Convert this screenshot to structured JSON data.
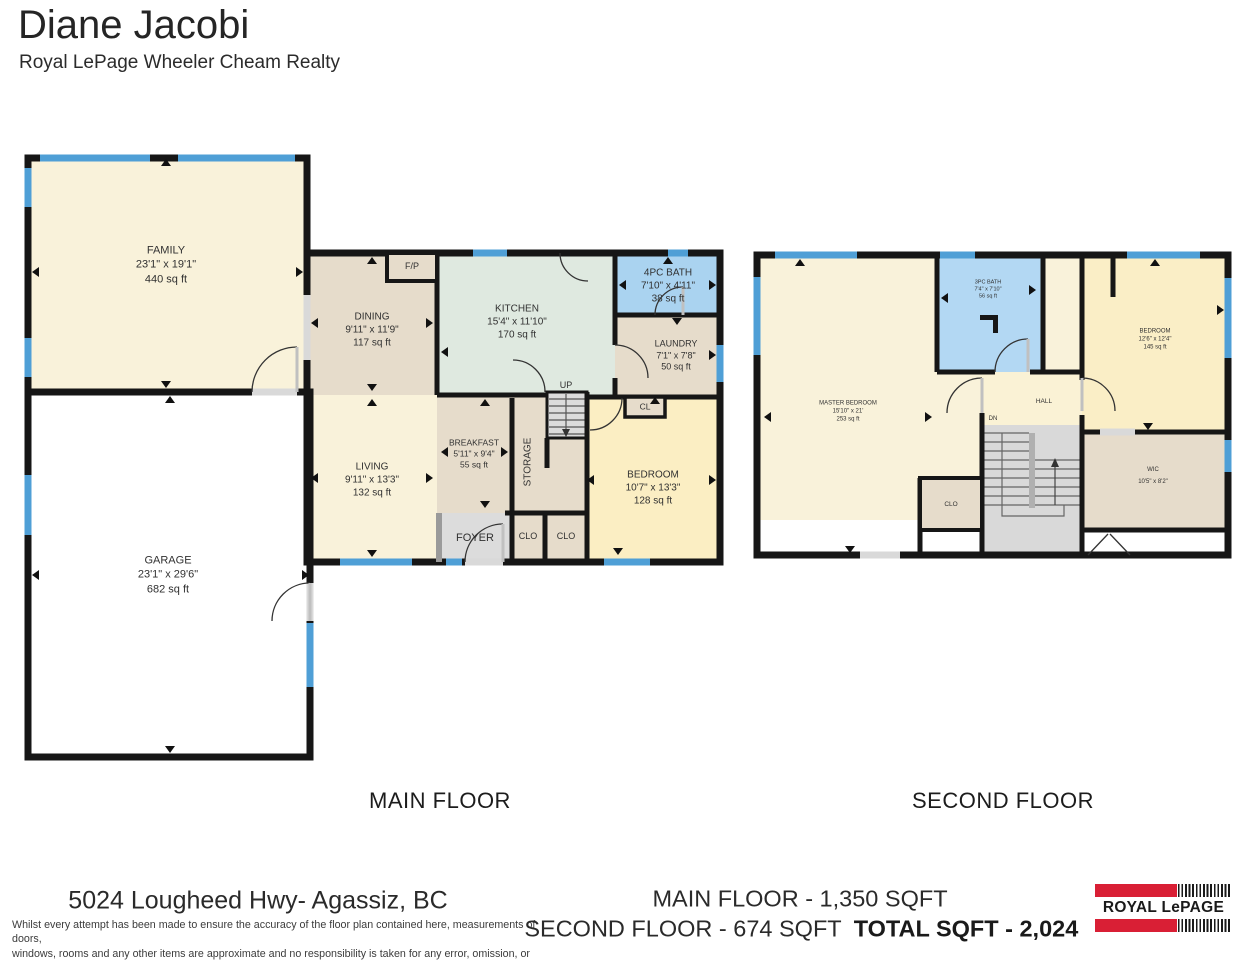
{
  "header": {
    "agent_name": "Diane Jacobi",
    "brokerage": "Royal LePage Wheeler Cheam Realty"
  },
  "main_floor": {
    "title": "MAIN FLOOR",
    "rooms": {
      "family": {
        "name": "FAMILY",
        "dims": "23'1\" x 19'1\"",
        "area": "440 sq ft"
      },
      "garage": {
        "name": "GARAGE",
        "dims": "23'1\" x 29'6\"",
        "area": "682 sq ft"
      },
      "dining": {
        "name": "DINING",
        "dims": "9'11\" x 11'9\"",
        "area": "117 sq ft"
      },
      "kitchen": {
        "name": "KITCHEN",
        "dims": "15'4\" x 11'10\"",
        "area": "170 sq ft"
      },
      "bath": {
        "name": "4PC BATH",
        "dims": "7'10\" x 4'11\"",
        "area": "38 sq ft"
      },
      "laundry": {
        "name": "LAUNDRY",
        "dims": "7'1\" x 7'8\"",
        "area": "50 sq ft"
      },
      "living": {
        "name": "LIVING",
        "dims": "9'11\" x 13'3\"",
        "area": "132 sq ft"
      },
      "breakfast": {
        "name": "BREAKFAST",
        "dims": "5'11\" x 9'4\"",
        "area": "55 sq ft"
      },
      "bedroom": {
        "name": "BEDROOM",
        "dims": "10'7\" x 13'3\"",
        "area": "128 sq ft"
      },
      "storage": {
        "name": "STORAGE"
      },
      "foyer": {
        "name": "FOYER"
      },
      "fireplace": {
        "name": "F/P"
      },
      "stairs_up": {
        "name": "UP"
      },
      "closet_cl": {
        "name": "CL"
      },
      "closet_clo": {
        "name": "CLO"
      }
    }
  },
  "second_floor": {
    "title": "SECOND FLOOR",
    "rooms": {
      "master": {
        "name": "MASTER BEDROOM",
        "dims": "15'10\" x 21'",
        "area": "253 sq ft"
      },
      "bath": {
        "name": "3PC BATH",
        "dims": "7'4\" x 7'10\"",
        "area": "56 sq ft"
      },
      "bedroom": {
        "name": "BEDROOM",
        "dims": "12'6\" x 12'4\"",
        "area": "145 sq ft"
      },
      "wic": {
        "name": "WIC",
        "dims": "10'5\" x 8'2\""
      },
      "hall": {
        "name": "HALL"
      },
      "stairs_dn": {
        "name": "DN"
      },
      "closet_clo": {
        "name": "CLO"
      }
    }
  },
  "footer": {
    "address": "5024 Lougheed Hwy- Agassiz, BC",
    "main_floor_total": "MAIN FLOOR - 1,350 SQFT",
    "second_floor_total": "SECOND FLOOR - 674 SQFT",
    "grand_total": "TOTAL SQFT - 2,024",
    "disclaimer_line1": "Whilst every attempt has been made to ensure the accuracy of the floor plan contained here, measurements of doors,",
    "disclaimer_line2": "windows, rooms and any other items are approximate and no responsibility is taken for any error, omission, or misstatement.",
    "disclaimer_line3": "This plan is for illustrative purposes only and should be used as such by any prospective purchaser.",
    "logo_brand": "ROYAL LePAGE"
  },
  "colors": {
    "wall": "#161616",
    "window_blue": "#4f9fd6",
    "room_cream": "#f9f2da",
    "room_tan": "#e6dccb",
    "room_mint": "#dfe9e0",
    "room_bath_blue": "#aad3f0",
    "room_bedroom_yellow": "#fbeec3",
    "room_gray": "#dcdcdc",
    "brand_red": "#d91f35"
  }
}
